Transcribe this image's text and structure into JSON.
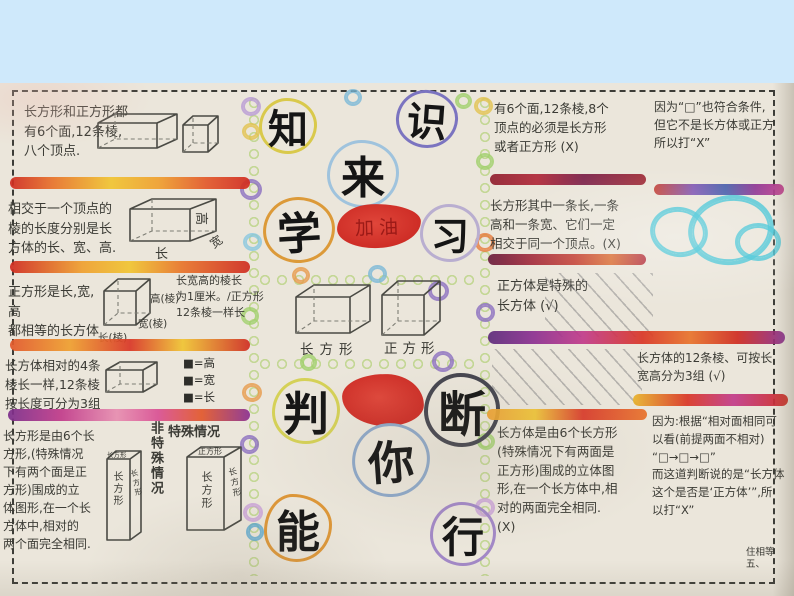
{
  "colors": {
    "slide_background": "#cfe9fb",
    "paper": "#ebe6db",
    "blob_red": "#ce2d26",
    "cyan_scribble": "#3fc4d6",
    "crayon_left": [
      "#cf2b20",
      "#e8732a",
      "#f0c431",
      "#ef9f2e",
      "#d02a1f"
    ],
    "crayon_purple_row": [
      "#7b2d8b",
      "#c13a8a",
      "#e78db0",
      "#e2572a"
    ],
    "crayon_right_dark": [
      "#8f1f2e",
      "#7a1f48",
      "#b02838"
    ]
  },
  "titles": {
    "top": {
      "chars": [
        {
          "ch": "知",
          "color": "#d9c94b"
        },
        {
          "ch": "识",
          "color": "#7b74c0"
        },
        {
          "ch": "来",
          "color": "#9fc3dd"
        },
        {
          "ch": "学",
          "color": "#dc9a39"
        },
        {
          "ch": "习",
          "color": "#b9aed0"
        }
      ],
      "cheer": "加油"
    },
    "bottom": {
      "chars": [
        {
          "ch": "判",
          "color": "#d5d157"
        },
        {
          "ch": "断",
          "color": "#45454f"
        },
        {
          "ch": "你",
          "color": "#8ea8c8"
        },
        {
          "ch": "能",
          "color": "#dd9637"
        },
        {
          "ch": "行",
          "color": "#a288c6"
        }
      ]
    }
  },
  "left": {
    "s1_text": "长方形和正方形都\n有6个面,12条棱,\n八个顶点.",
    "s2_text": "相交于一个顶点的\n棱的长度分别是长\n方体的长、宽、高.",
    "s2_labels": {
      "height": "高",
      "length": "长",
      "width": "宽"
    },
    "s3_text": "正方形是长,宽,高\n都相等的长方体",
    "s3_labels": {
      "h": "高(棱)",
      "w": "宽(棱)",
      "l": "长(棱)"
    },
    "s3_note": "长宽高的棱长\n为1厘米。/正方形\n12条棱一样长",
    "s4_text": "长方体相对的4条\n棱长一样,12条棱\n按长度可分为3组",
    "s4_legend": [
      "■=高",
      "■=宽",
      "■=长"
    ],
    "s5_text": "长方形是由6个长\n方形,(特殊情况\n下有两个面是正\n方形)围成的立\n体图形,在一个长\n方体中,相对的\n两个面完全相同.",
    "s5_heading_normal": "非特殊情况",
    "s5_heading_special": "特殊情况",
    "s5_box1_front": "长方形",
    "s5_box1_side": "长方形",
    "s5_box1_top": "长方形",
    "s5_box2_top": "正方形",
    "s5_box2_front": "长方形",
    "s5_box2_side": "长方形"
  },
  "middle": {
    "box1_label": "长方形",
    "box2_label": "正方形"
  },
  "right": {
    "q1": "有6个面,12条棱,8个\n顶点的必须是长方形\n或者正方形    (X)",
    "q2": "长方形其中一条长,一条\n高和一条宽、它们一定\n相交于同一个顶点。(X)",
    "q3": "正方体是特殊的\n长方体 (√)",
    "q4": "长方体的12条棱、可按长\n宽高分为3组  (√)",
    "q5": "长方体是由6个长方形\n(特殊情况下有两面是\n正方形)围成的立体图\n形,在一个长方体中,相\n对的两面完全相同.\n   (X)"
  },
  "far_right": {
    "a1": "因为“□”也符合条件,\n但它不是长方体或正方\n所以打“X”",
    "a2": "因为:根据“相对面相同可\n以看(前提两面不相对)\n“□→□→□”\n而这道判断说的是“长方体\n这个是否是‘正方体’”,所\n以打“X”",
    "corner_note": "住相等\n五、"
  }
}
